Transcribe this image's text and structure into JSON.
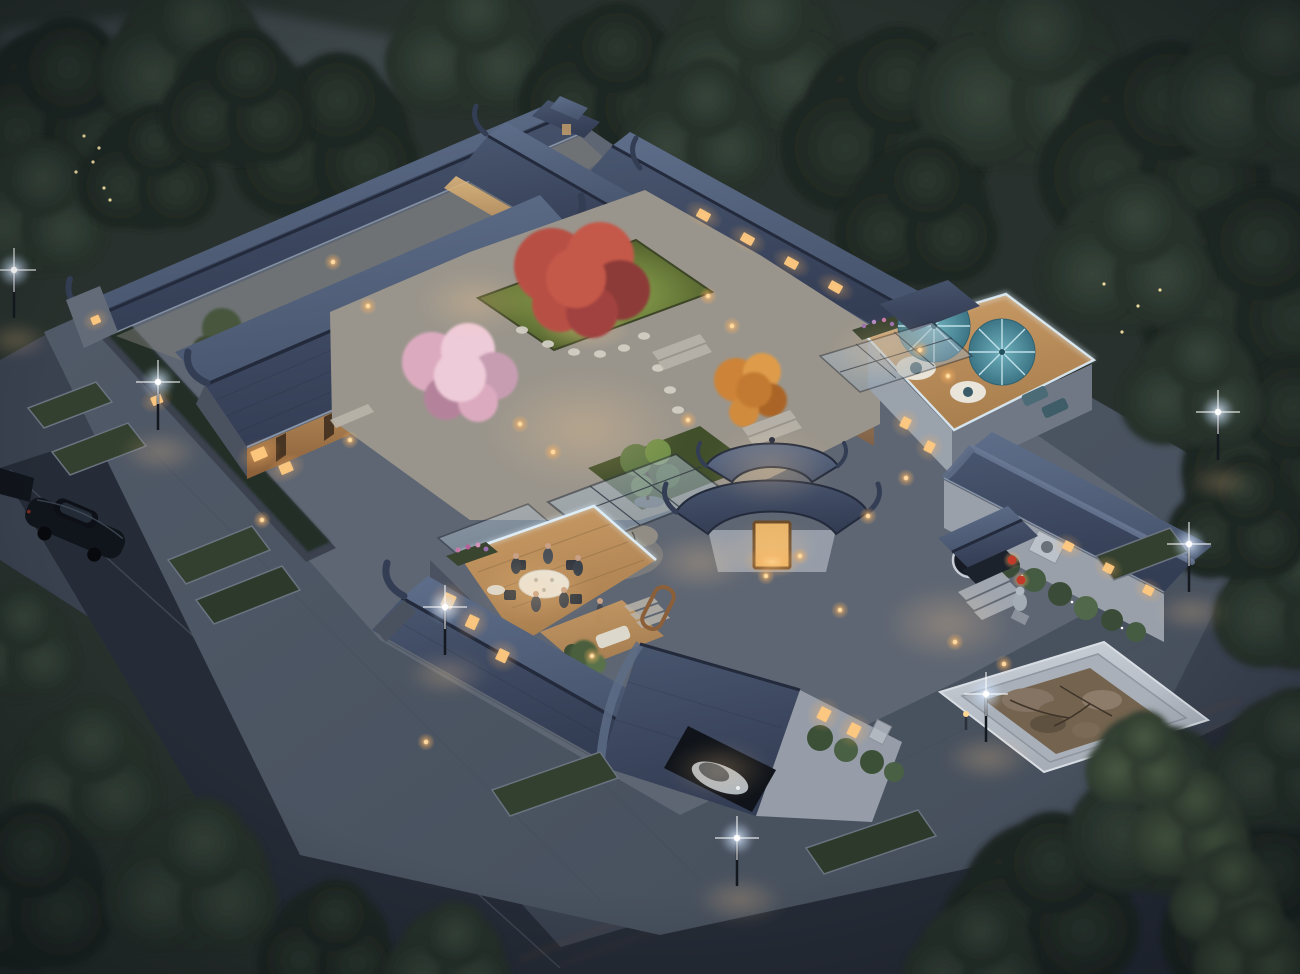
{
  "meta": {
    "description": "Aerial dusk rendering of a traditional Chinese siheyuan courtyard mansion: blue-tile curved roofs around lit inner courtyards with a red maple, cherry blossom and autumn trees, a rock sculpture, rooftop dining terrace with people, a roof deck with teal umbrellas, stone entrance with lion statue and red lanterns, marble rock-pool plaza, streets with lamps, parked cars and dense surrounding trees."
  },
  "palette": {
    "base_ground": "#3a4250",
    "street": "#262c37",
    "sidewalk_a": "#525b69",
    "sidewalk_b": "#454e5b",
    "grass_dark": "#28312d",
    "roof_light": "#5e6e8a",
    "roof_mid": "#49566f",
    "roof_dark": "#333d54",
    "roof_ridge": "#222a3c",
    "eave": "#93a0b4",
    "wall_light": "#969da8",
    "wall_dark": "#5b6270",
    "warm_hi": "#e8bd7d",
    "warm_lo": "#8a5f39",
    "warm_core": "#ffd894",
    "warm_mid": "#ffb25e",
    "lamp_core": "#ffffff",
    "lamp_glow": "#cfe4ff",
    "glass_a": "#b9c9d6",
    "glass_b": "#8fa2b2",
    "glass_frame": "#2c3440",
    "deck_lit": "#cb9c66",
    "deck": "#a97f4f",
    "umbrella_hi": "#6fb0bd",
    "umbrella_lo": "#3c7585",
    "table_white": "#e9e5da",
    "blossom": "#dcaabf",
    "blossom_light": "#eecbd8",
    "maple": "#b84f45",
    "maple_dark": "#8d3a37",
    "autumn": "#cd8338",
    "garden_lit": "#9cb457",
    "garden": "#56652f",
    "stone": "#d2cec4",
    "marble_a": "#ccd2d9",
    "marble_b": "#a6adb7",
    "pool_rock": "#74644f",
    "car_dark": "#10141b",
    "car_silver": "#aeb7bf",
    "hedge": "#242e26",
    "parapet": "#dff0fb",
    "lantern_red": "#c23b2a",
    "tree_d1_a": "#2c3830",
    "tree_d1_b": "#1c2420",
    "tree_d2_a": "#37453a",
    "tree_d2_b": "#242e28",
    "tree_lt_a": "#4a5c44",
    "tree_lt_b": "#2f3b2f"
  },
  "scene": {
    "street_lamps": [
      [
        14,
        316
      ],
      [
        158,
        428
      ],
      [
        445,
        653
      ],
      [
        737,
        884
      ],
      [
        1218,
        458
      ],
      [
        1189,
        590
      ],
      [
        986,
        740
      ]
    ],
    "bollard_lights": [
      [
        333,
        262
      ],
      [
        368,
        306
      ],
      [
        520,
        424
      ],
      [
        553,
        452
      ],
      [
        708,
        296
      ],
      [
        732,
        326
      ],
      [
        766,
        576
      ],
      [
        800,
        556
      ],
      [
        868,
        516
      ],
      [
        592,
        656
      ],
      [
        906,
        478
      ],
      [
        955,
        642
      ],
      [
        426,
        742
      ],
      [
        688,
        420
      ],
      [
        350,
        440
      ],
      [
        262,
        520
      ],
      [
        840,
        610
      ],
      [
        1004,
        664
      ],
      [
        920,
        350
      ],
      [
        948,
        376
      ]
    ],
    "warm_pools": [
      [
        585,
        430,
        100,
        58
      ],
      [
        475,
        302,
        56,
        32
      ],
      [
        770,
        468,
        64,
        38
      ],
      [
        948,
        624,
        66,
        40
      ],
      [
        700,
        562,
        54,
        30
      ],
      [
        160,
        452,
        42,
        22
      ],
      [
        447,
        674,
        42,
        22
      ],
      [
        988,
        758,
        46,
        24
      ],
      [
        1192,
        612,
        40,
        20
      ],
      [
        740,
        900,
        46,
        24
      ],
      [
        16,
        340,
        34,
        18
      ],
      [
        1220,
        482,
        34,
        18
      ],
      [
        889,
        352,
        58,
        34
      ],
      [
        536,
        590,
        60,
        34
      ],
      [
        772,
        548,
        46,
        26
      ],
      [
        720,
        770,
        50,
        28
      ]
    ],
    "window_lights": [
      [
        250,
        452,
        15,
        11,
        -23
      ],
      [
        278,
        466,
        13,
        10,
        -23
      ],
      [
        150,
        398,
        11,
        9,
        -23
      ],
      [
        90,
        318,
        9,
        8,
        -23
      ],
      [
        446,
        592,
        12,
        14,
        25
      ],
      [
        470,
        614,
        11,
        13,
        25
      ],
      [
        500,
        648,
        11,
        12,
        25
      ],
      [
        822,
        706,
        11,
        13,
        27
      ],
      [
        852,
        722,
        11,
        13,
        27
      ],
      [
        904,
        416,
        9,
        11,
        27
      ],
      [
        928,
        440,
        9,
        11,
        27
      ],
      [
        1066,
        540,
        10,
        9,
        27
      ],
      [
        1106,
        562,
        10,
        9,
        27
      ],
      [
        1146,
        584,
        10,
        9,
        27
      ],
      [
        700,
        208,
        13,
        9,
        29
      ],
      [
        744,
        232,
        13,
        9,
        29
      ],
      [
        788,
        256,
        13,
        9,
        29
      ],
      [
        832,
        280,
        13,
        9,
        29
      ]
    ],
    "fireflies": [
      [
        84,
        136
      ],
      [
        93,
        162
      ],
      [
        104,
        188
      ],
      [
        76,
        172
      ],
      [
        99,
        148
      ],
      [
        110,
        200
      ],
      [
        1104,
        284
      ],
      [
        1138,
        306
      ],
      [
        1122,
        332
      ],
      [
        1160,
        290
      ]
    ],
    "trees_back": [
      [
        60,
        110,
        85,
        "d1"
      ],
      [
        190,
        55,
        75,
        "d2"
      ],
      [
        330,
        140,
        80,
        "d1"
      ],
      [
        470,
        45,
        70,
        "d2"
      ],
      [
        610,
        85,
        75,
        "d1"
      ],
      [
        755,
        55,
        85,
        "d2"
      ],
      [
        890,
        125,
        90,
        "d1"
      ],
      [
        1030,
        75,
        95,
        "d2"
      ],
      [
        1160,
        150,
        100,
        "d1"
      ],
      [
        1270,
        80,
        85,
        "d2"
      ],
      [
        1255,
        290,
        95,
        "d1"
      ],
      [
        1130,
        255,
        75,
        "d2"
      ],
      [
        1285,
        450,
        85,
        "d1"
      ],
      [
        1195,
        385,
        62,
        "d2"
      ],
      [
        35,
        210,
        65,
        "d2"
      ],
      [
        150,
        170,
        60,
        "d1"
      ],
      [
        920,
        215,
        70,
        "d1"
      ],
      [
        700,
        130,
        65,
        "d2"
      ],
      [
        240,
        100,
        65,
        "d1"
      ],
      [
        1298,
        600,
        70,
        "d2"
      ],
      [
        1240,
        520,
        60,
        "d1"
      ]
    ],
    "trees_front": [
      [
        85,
        775,
        70,
        "d2"
      ],
      [
        25,
        890,
        80,
        "d1"
      ],
      [
        195,
        880,
        75,
        "d2"
      ],
      [
        330,
        945,
        60,
        "d1"
      ],
      [
        18,
        645,
        55,
        "d2"
      ],
      [
        1045,
        905,
        85,
        "d1"
      ],
      [
        1165,
        815,
        80,
        "d2"
      ],
      [
        1265,
        915,
        85,
        "d1"
      ],
      [
        975,
        962,
        60,
        "d2"
      ],
      [
        1288,
        762,
        68,
        "d2"
      ],
      [
        450,
        962,
        55,
        "d2"
      ],
      [
        1192,
        826,
        52,
        "lt"
      ],
      [
        1228,
        896,
        48,
        "lt"
      ],
      [
        1252,
        952,
        48,
        "lt"
      ],
      [
        1140,
        760,
        45,
        "lt"
      ]
    ]
  }
}
